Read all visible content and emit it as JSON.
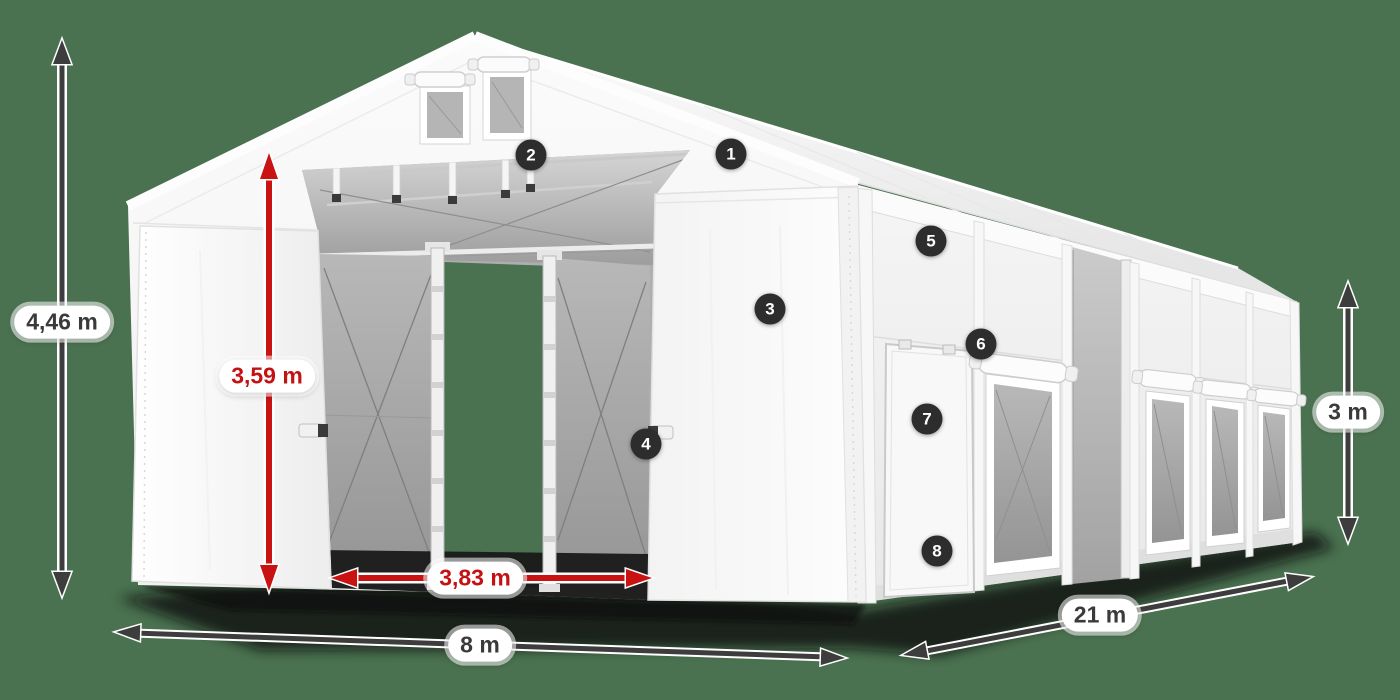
{
  "dimension_labels": {
    "total_height": "4,46 m",
    "entrance_height": "3,59 m",
    "entrance_width": "3,83 m",
    "front_width": "8 m",
    "side_length": "21 m",
    "side_wall_height": "3 m"
  },
  "callouts": [
    "1",
    "2",
    "3",
    "4",
    "5",
    "6",
    "7",
    "8"
  ],
  "colors": {
    "background": "#4a7150",
    "accent_red": "#c81312",
    "arrow_dark": "#3d3d3d",
    "callout_bg": "#2d2d2d",
    "pill_bg": "#ffffff",
    "pill_text_dark": "#3a3a3a",
    "tent_white": "#f7f7f7",
    "mesh_gray": "#aeaeae"
  }
}
